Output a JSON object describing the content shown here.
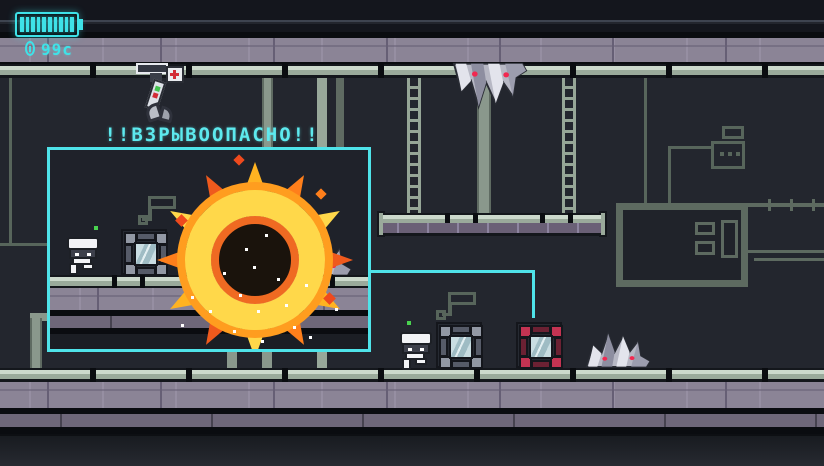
{
  "hud": {
    "health_bar": {
      "segments_total": 10,
      "segments_filled": 10
    },
    "coin_counter": {
      "icon": "coin-icon",
      "value": "99c"
    }
  },
  "warning": {
    "text": "!!ВЗРЫВООПАСНО!!"
  },
  "callout": {
    "description": "zoomed preview of an explosive crate detonating next to a robot and a spike enemy",
    "connector_target": "explosive-crate"
  },
  "entities": {
    "robots": [
      "robot-callout",
      "robot-floor"
    ],
    "crates": [
      "metal-crate-callout",
      "metal-crate-floor",
      "explosive-crate"
    ],
    "enemies": [
      "spike-enemy-ceiling",
      "spike-enemy-callout",
      "spike-enemy-floor"
    ],
    "machines": [
      "claw-dispenser",
      "medkit-box"
    ],
    "props": [
      "chain-left",
      "chain-right",
      "hanging-platform"
    ]
  },
  "colors": {
    "ui_cyan": "#4fe3e9",
    "explosion_yellow": "#ffd84a",
    "explosion_orange": "#ff9d1f",
    "explosion_red": "#ef4a1d",
    "danger_red": "#c43352",
    "tile_sage": "#9aaa9b",
    "band_purple": "#8b8496",
    "room_bg": "#23262e"
  }
}
